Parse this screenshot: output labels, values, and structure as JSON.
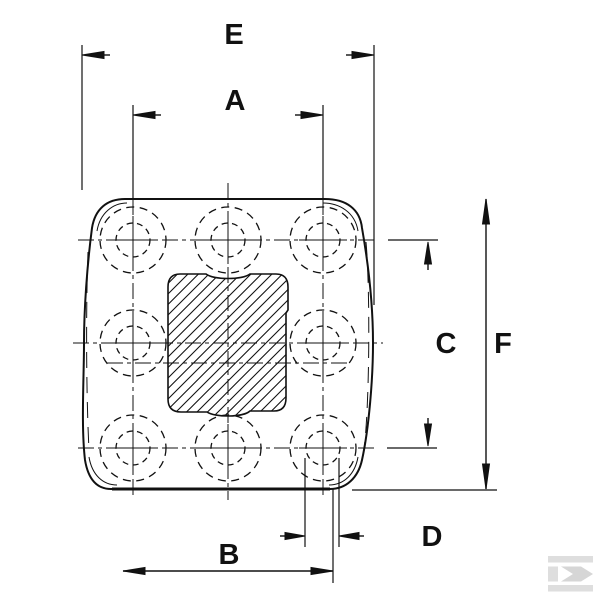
{
  "diagram": {
    "type": "technical-dimension-drawing",
    "subject": "square mounting plate / pedal pad, top view, 3x3 bolt-hole grid (8 holes, center occupied by hatched pad)",
    "dimensions": {
      "E": "E",
      "A": "A",
      "B": "B",
      "C": "C",
      "D": "D",
      "F": "F"
    },
    "dimension_meanings": {
      "E": "overall horizontal span between outer extension lines (top)",
      "A": "horizontal distance between outer hole columns (top)",
      "B": "horizontal distance, lower dimension line",
      "C": "vertical distance between top and bottom hole rows (right side)",
      "D": "small horizontal width at bottom-right hole",
      "F": "overall vertical height (far right)"
    },
    "features": {
      "hole_count": 8,
      "hole_style": "two concentric dashed circles with centerline cross",
      "center_pad": "rounded square region with 45-degree hatching",
      "outline": "rounded square with slightly bulged sides, doubled corner lines"
    },
    "colors": {
      "line": "#111111",
      "background": "#ffffff",
      "watermark": "#dedede"
    },
    "watermark": {
      "name": "kramp-logo",
      "glyph": "K"
    }
  }
}
